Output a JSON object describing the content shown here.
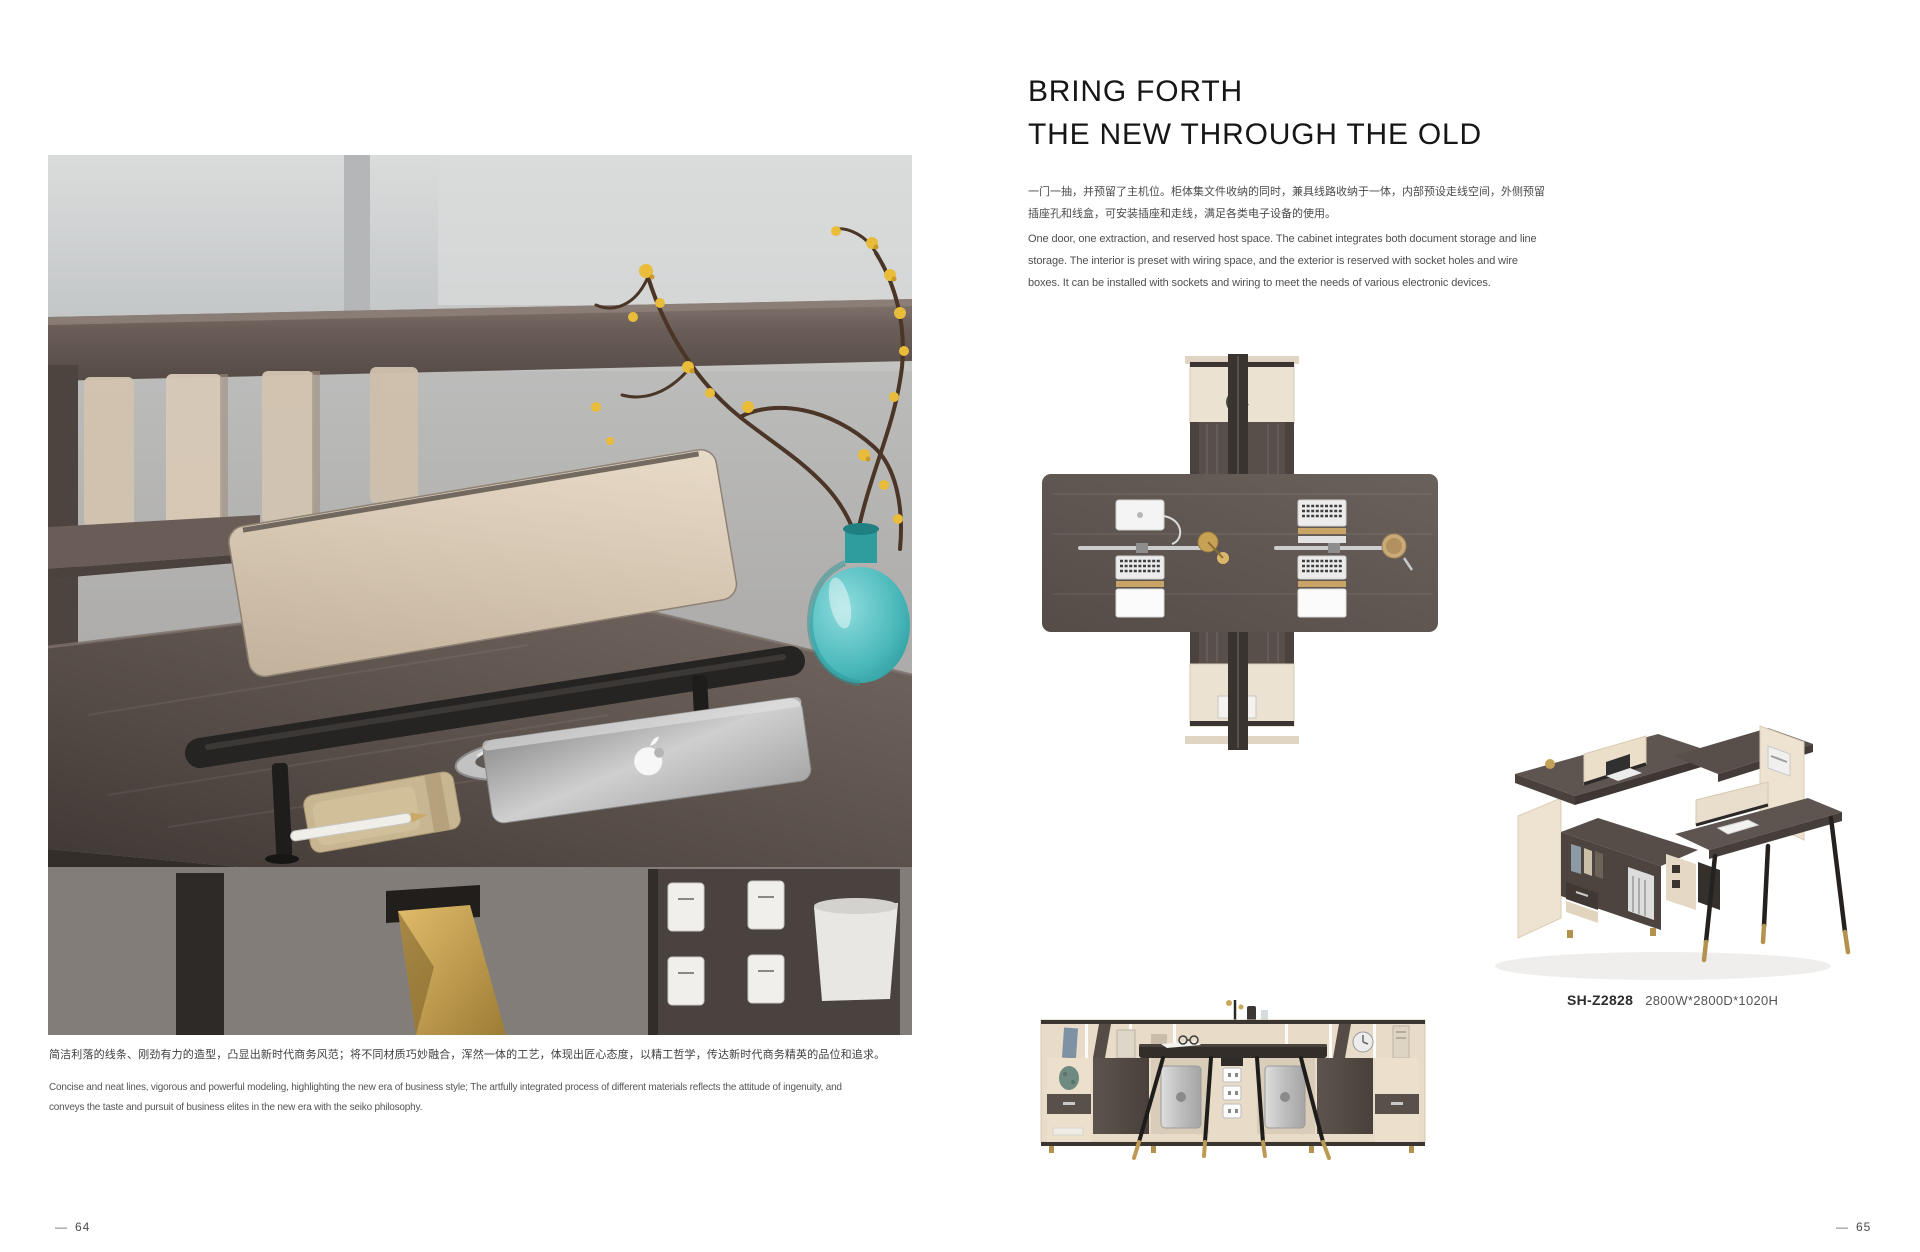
{
  "left_page": {
    "caption_zh": "简洁利落的线条、刚劲有力的造型，凸显出新时代商务风范；将不同材质巧妙融合，浑然一体的工艺，体现出匠心态度，以精工哲学，传达新时代商务精英的品位和追求。",
    "caption_en_line1": "Concise and neat lines, vigorous and powerful modeling, highlighting the new era of business style; The artfully integrated process of different materials reflects the attitude of ingenuity, and",
    "caption_en_line2": "conveys the taste and pursuit of business elites in the new era with the seiko philosophy.",
    "page_number_prefix": "—",
    "page_number": "64"
  },
  "right_page": {
    "title_line1": "BRING FORTH",
    "title_line2": "THE NEW THROUGH THE OLD",
    "body_zh_line1": "一门一抽，并预留了主机位。柜体集文件收纳的同时，兼具线路收纳于一体，内部预设走线空间，外侧预留",
    "body_zh_line2": "插座孔和线盒，可安装插座和走线，满足各类电子设备的使用。",
    "body_en_line1": "One door, one extraction, and reserved host space. The cabinet integrates both document storage and line",
    "body_en_line2": "storage. The interior is preset with wiring space, and the exterior is reserved with socket holes and wire",
    "body_en_line3": "boxes. It can be installed with sockets and wiring to meet the needs of various electronic devices.",
    "product": {
      "model": "SH-Z2828",
      "dimensions": "2800W*2800D*1020H"
    },
    "page_number_prefix": "—",
    "page_number": "65"
  },
  "colors": {
    "paper": "#ffffff",
    "ink": "#161616",
    "body_text": "#4f4f4f",
    "wood_dark": "#574e4a",
    "beige": "#e9decb",
    "teal_vase": "#49b8ba",
    "gold_accent": "#b3924f"
  }
}
